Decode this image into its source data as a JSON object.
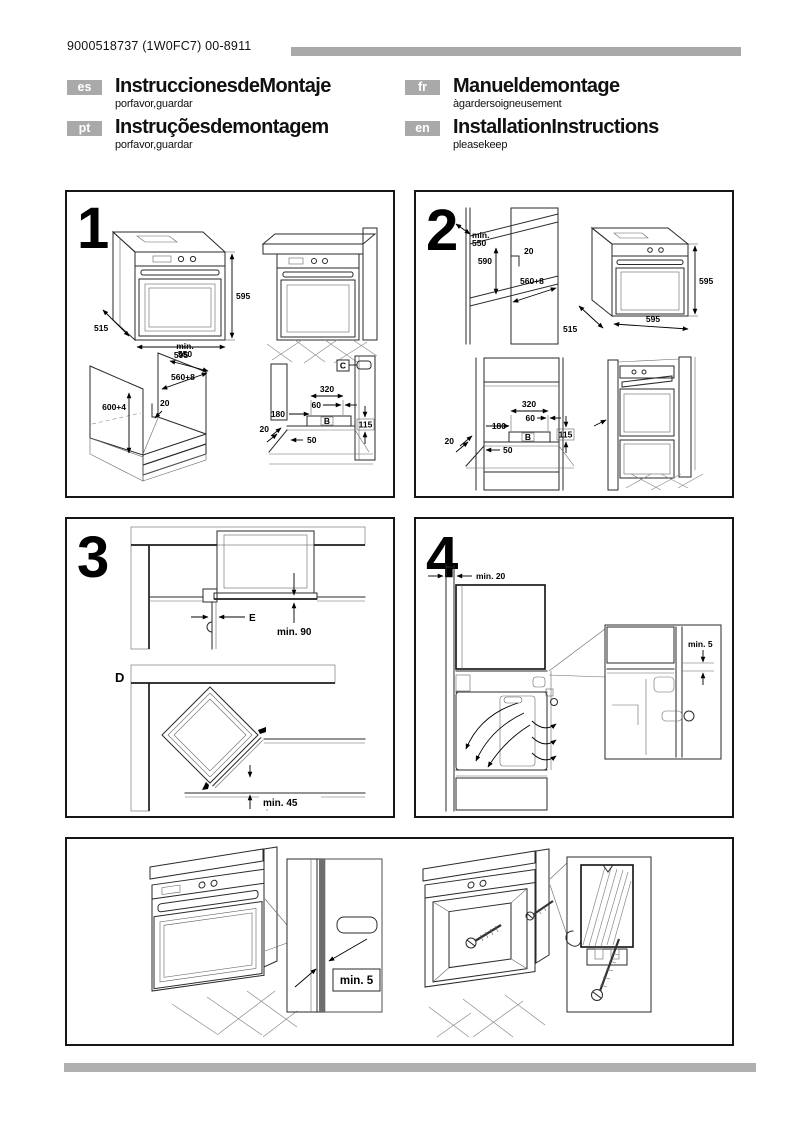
{
  "page": {
    "doc_number": "9000518737 (1W0FC7) 00-8911"
  },
  "header": {
    "languages": [
      {
        "code": "es",
        "title": "InstruccionesdeMontaje",
        "subtitle": "porfavor,guardar"
      },
      {
        "code": "fr",
        "title": "Manueldemontage",
        "subtitle": "àgardersoigneusement"
      },
      {
        "code": "pt",
        "title": "Instruçõesdemontagem",
        "subtitle": "porfavor,guardar"
      },
      {
        "code": "en",
        "title": "InstallationInstructions",
        "subtitle": "pleasekeep"
      }
    ]
  },
  "panel1": {
    "number": "1",
    "oven": {
      "h": "595",
      "d": "515",
      "w": "595"
    },
    "cabinet": {
      "min_label": "min.",
      "min_value": "550",
      "width": "560+8",
      "gap": "20",
      "height": "600+4"
    },
    "niche": {
      "connector": "C",
      "w320": "320",
      "w60": "60",
      "h180": "180",
      "gap20": "20",
      "d50": "50",
      "zone": "B",
      "h115": "115"
    }
  },
  "panel2": {
    "number": "2",
    "column": {
      "min_label": "min.",
      "min_value": "550",
      "h590": "590",
      "gap20": "20",
      "w560": "560+8"
    },
    "oven": {
      "h": "595",
      "d": "515",
      "w": "595"
    },
    "niche": {
      "w320": "320",
      "w60": "60",
      "h180": "180",
      "gap20": "20",
      "d50": "50",
      "zone": "B",
      "h115": "115"
    }
  },
  "panel3": {
    "number": "3",
    "label_e": "E",
    "min90": "min. 90",
    "label_d": "D",
    "min45": "min. 45"
  },
  "panel4": {
    "number": "4",
    "min20": "min. 20",
    "min5": "min. 5"
  },
  "panel5": {
    "min5": "min. 5"
  },
  "colors": {
    "accent_gray": "#a9a9a9",
    "panel_fill": "#dcdcdc"
  }
}
